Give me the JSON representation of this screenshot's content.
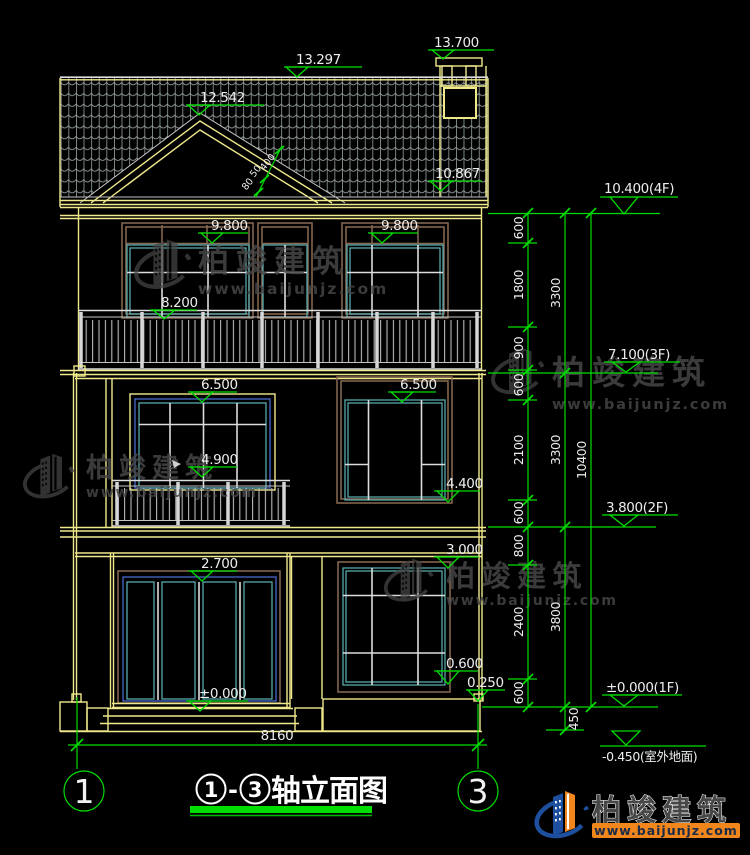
{
  "labels": {
    "chimney": "13.700",
    "ridge": "13.297",
    "gable": "12.542",
    "eave": "10.867",
    "f3_left": "9.800",
    "f3_right": "9.800",
    "f3_rail": "8.200",
    "f2_left": "6.500",
    "f2_right": "6.500",
    "f2_rail": "4.900",
    "f2_sill": "4.400",
    "f1_win_top": "3.000",
    "f1_door_top": "2.700",
    "f1_floor": "±0.000",
    "f1_sill": "0.600",
    "plinth": "0.250"
  },
  "levels": {
    "f4": "10.400(4F)",
    "f3": "7.100(3F)",
    "f2": "3.800(2F)",
    "f1": "±0.000(1F)",
    "ground": "-0.450(室外地面)"
  },
  "chain": {
    "c1": [
      "600",
      "1800",
      "900",
      "600",
      "2100",
      "600",
      "800",
      "2400",
      "600"
    ],
    "c2": [
      "3300",
      "3300",
      "3800",
      "450"
    ],
    "c3": [
      "10400"
    ]
  },
  "slope_dims": [
    "80",
    "50",
    "400"
  ],
  "axis": {
    "left": "1",
    "right": "3",
    "width": "8160"
  },
  "title": {
    "c1": "1",
    "dash": "-",
    "c2": "3",
    "text": "轴立面图"
  },
  "watermark": {
    "brand": "柏竣建筑",
    "url": "www.baijunjz.com"
  },
  "logo": {
    "brand": "柏竣建筑",
    "url": "www.baijunjz.com"
  },
  "colors": {
    "dim_green": "#00dc00",
    "wall_yellow": "#efe98b",
    "window_cyan": "#57a8ac",
    "frame_brown": "#8a6a52",
    "frame_blue": "#4868cc",
    "logo_blue": "#1d4f9e",
    "logo_orange": "#f0861c"
  }
}
